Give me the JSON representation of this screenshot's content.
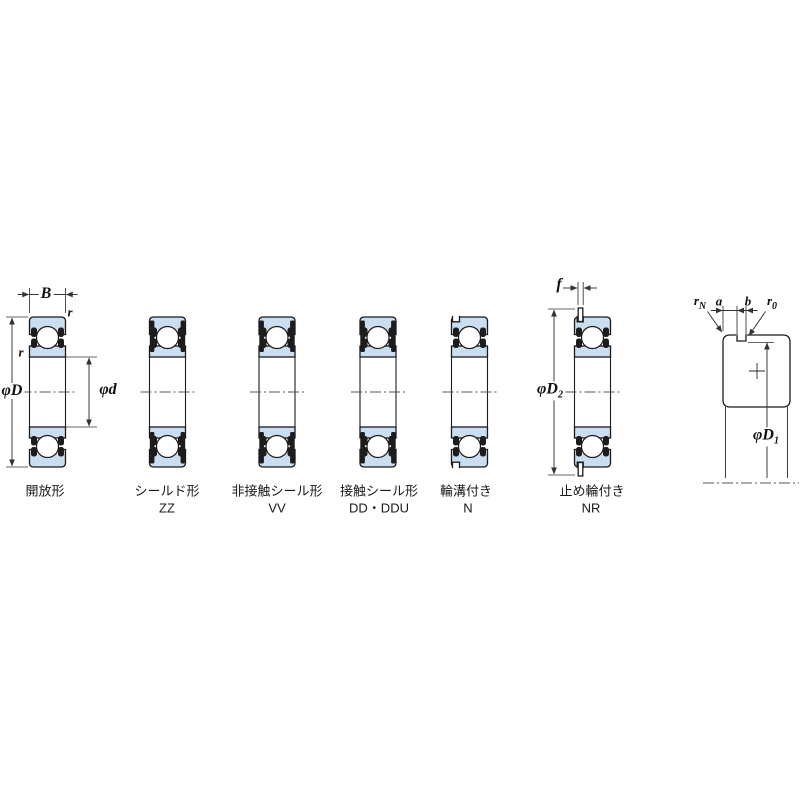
{
  "diagram": {
    "title_hidden": "",
    "captions": [
      {
        "jp": "開放形",
        "code": ""
      },
      {
        "jp": "シールド形",
        "code": "ZZ"
      },
      {
        "jp": "非接触シール形",
        "code": "VV"
      },
      {
        "jp": "接触シール形",
        "code": "DD・DDU"
      },
      {
        "jp": "輪溝付き",
        "code": "N"
      },
      {
        "jp": "止め輪付き",
        "code": "NR"
      }
    ],
    "dims": {
      "B": "B",
      "r_outer": "r",
      "r_inner": "r",
      "phiD": "φD",
      "phid": "φd",
      "f": "f",
      "phiD2_main": "φD",
      "phiD2_sub": "2",
      "phiD1_main": "φD",
      "phiD1_sub": "1",
      "a": "a",
      "b": "b",
      "rN_main": "r",
      "rN_sub": "N",
      "r0_main": "r",
      "r0_sub": "0"
    },
    "colors": {
      "ring_fill": "#c9def1",
      "outline": "#1b1b1b",
      "dimension_line": "#333333",
      "background": "#ffffff"
    }
  }
}
